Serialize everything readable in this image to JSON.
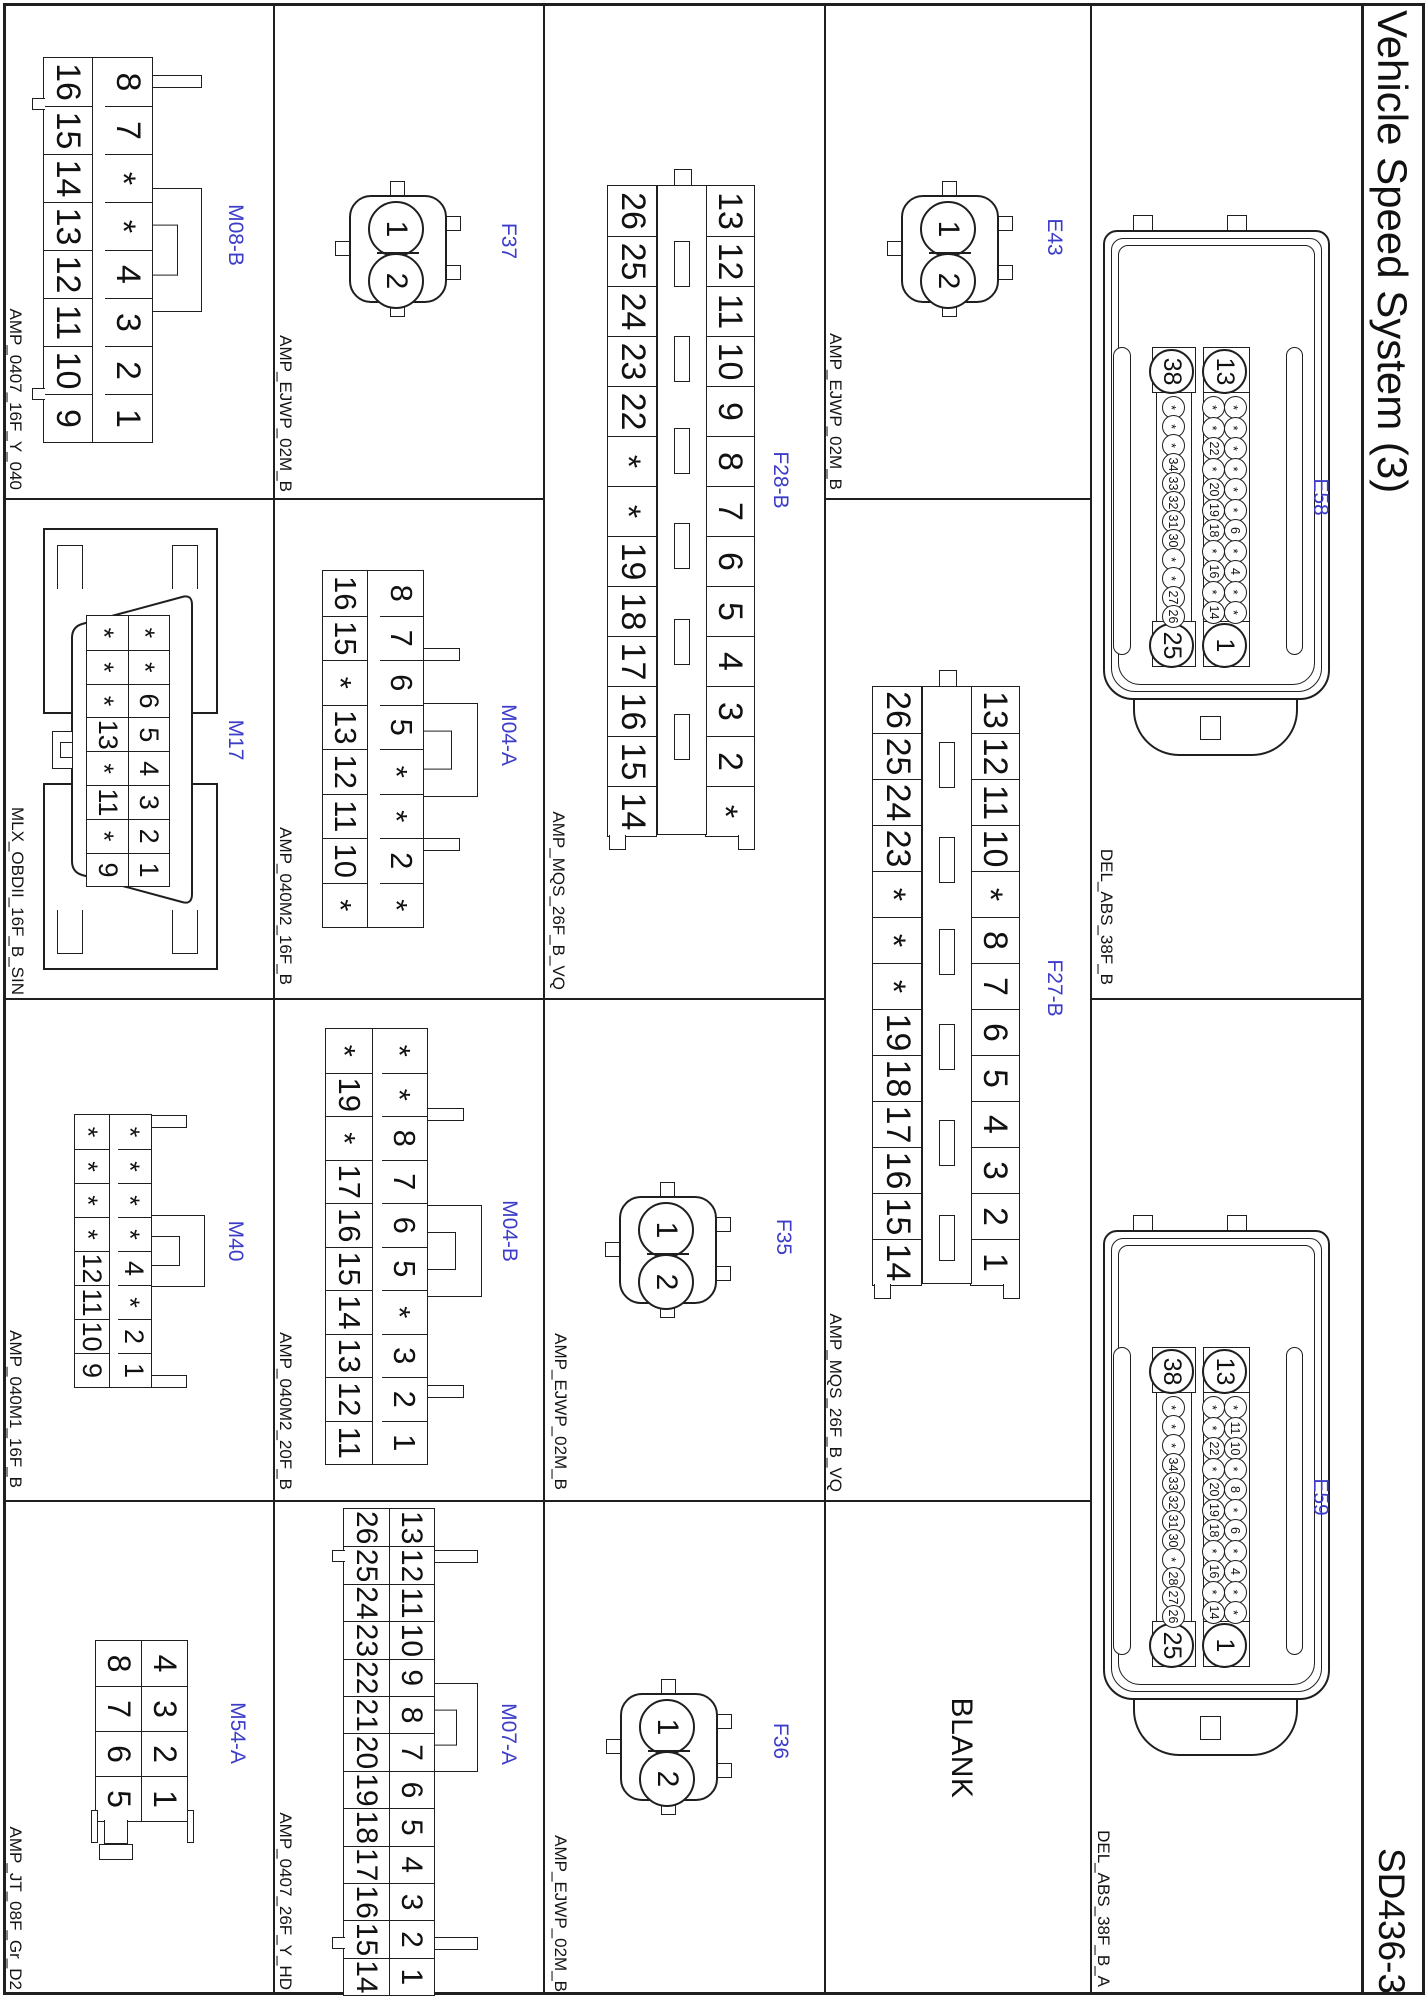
{
  "sheet": {
    "title": "Vehicle Speed System (3)",
    "doc_number": "SD436-3",
    "blank_cell_label": "BLANK",
    "accent_color": "#3c3cc8",
    "line_color": "#1f1f1f"
  },
  "connectors": [
    {
      "id": "E58",
      "part": "DEL_ABS_38F_B",
      "type": "del38",
      "corners": {
        "top_left": "13",
        "top_right": "1",
        "bottom_left": "38",
        "bottom_right": "25"
      },
      "upper_top": [
        "*",
        "*",
        "*",
        "*",
        "*",
        "*",
        "6",
        "*",
        "4",
        "*",
        "*"
      ],
      "upper_bottom": [
        "*",
        "*",
        "22",
        "*",
        "20",
        "19",
        "18",
        "*",
        "16",
        "*",
        "14"
      ],
      "lower": [
        "*",
        "*",
        "*",
        "34",
        "33",
        "32",
        "31",
        "30",
        "*",
        "*",
        "27",
        "26"
      ]
    },
    {
      "id": "E59",
      "part": "DEL_ABS_38F_B_A",
      "type": "del38",
      "corners": {
        "top_left": "13",
        "top_right": "1",
        "bottom_left": "38",
        "bottom_right": "25"
      },
      "upper_top": [
        "*",
        "11",
        "10",
        "*",
        "8",
        "*",
        "6",
        "*",
        "4",
        "*",
        "*"
      ],
      "upper_bottom": [
        "*",
        "*",
        "22",
        "*",
        "20",
        "19",
        "18",
        "*",
        "16",
        "*",
        "14"
      ],
      "lower": [
        "*",
        "*",
        "*",
        "34",
        "33",
        "32",
        "31",
        "30",
        "*",
        "28",
        "27",
        "26"
      ]
    },
    {
      "id": "E43",
      "part": "AMP_EJWP_02M_B",
      "type": "twopin",
      "pins": [
        "1",
        "2"
      ]
    },
    {
      "id": "F27-B",
      "part": "AMP_MQS_26F_B_VQ",
      "type": "mqs",
      "row_top": [
        "13",
        "12",
        "11",
        "10",
        "*",
        "8",
        "7",
        "6",
        "5",
        "4",
        "3",
        "2",
        "1"
      ],
      "row_bottom": [
        "26",
        "25",
        "24",
        "23",
        "*",
        "*",
        "*",
        "19",
        "18",
        "17",
        "16",
        "15",
        "14"
      ]
    },
    {
      "id": "F28-B",
      "part": "AMP_MQS_26F_B_VQ",
      "type": "mqs",
      "row_top": [
        "13",
        "12",
        "11",
        "10",
        "9",
        "8",
        "7",
        "6",
        "5",
        "4",
        "3",
        "2",
        "*"
      ],
      "row_bottom": [
        "26",
        "25",
        "24",
        "23",
        "22",
        "*",
        "*",
        "19",
        "18",
        "17",
        "16",
        "15",
        "14"
      ]
    },
    {
      "id": "F35",
      "part": "AMP_EJWP_02M_B",
      "type": "twopin",
      "pins": [
        "1",
        "2"
      ]
    },
    {
      "id": "F36",
      "part": "AMP_EJWP_02M_B",
      "type": "twopin",
      "pins": [
        "1",
        "2"
      ]
    },
    {
      "id": "F37",
      "part": "AMP_EJWP_02M_B",
      "type": "twopin",
      "pins": [
        "1",
        "2"
      ]
    },
    {
      "id": "M04-A",
      "part": "AMP_040M2_16F_B",
      "type": "grid",
      "row_top": [
        "8",
        "7",
        "6",
        "5",
        "*",
        "*",
        "2",
        "*"
      ],
      "row_bottom": [
        "16",
        "15",
        "*",
        "13",
        "12",
        "11",
        "10",
        "*"
      ]
    },
    {
      "id": "M04-B",
      "part": "AMP_040M2_20F_B",
      "type": "grid",
      "row_top": [
        "*",
        "*",
        "8",
        "7",
        "6",
        "5",
        "*",
        "3",
        "2",
        "1"
      ],
      "row_bottom": [
        "*",
        "19",
        "*",
        "17",
        "16",
        "15",
        "14",
        "13",
        "12",
        "11"
      ]
    },
    {
      "id": "M07-A",
      "part": "AMP_0407_26F_Y_HD",
      "type": "grid",
      "row_top": [
        "13",
        "12",
        "11",
        "10",
        "9",
        "8",
        "7",
        "6",
        "5",
        "4",
        "3",
        "2",
        "1"
      ],
      "row_bottom": [
        "26",
        "25",
        "24",
        "23",
        "22",
        "21",
        "20",
        "19",
        "18",
        "17",
        "16",
        "15",
        "14"
      ]
    },
    {
      "id": "M08-B",
      "part": "AMP_0407_16F_Y_040",
      "type": "grid",
      "row_top": [
        "8",
        "7",
        "*",
        "*",
        "4",
        "3",
        "2",
        "1"
      ],
      "row_bottom": [
        "16",
        "15",
        "14",
        "13",
        "12",
        "11",
        "10",
        "9"
      ]
    },
    {
      "id": "M17",
      "part": "MLX_OBDII_16F_B_SIN",
      "type": "obd",
      "row_top": [
        "*",
        "*",
        "6",
        "5",
        "4",
        "3",
        "2",
        "1"
      ],
      "row_bottom": [
        "*",
        "*",
        "*",
        "13",
        "*",
        "11",
        "*",
        "9"
      ]
    },
    {
      "id": "M40",
      "part": "AMP_040M1_16F_B",
      "type": "grid",
      "row_top": [
        "*",
        "*",
        "*",
        "*",
        "4",
        "*",
        "2",
        "1"
      ],
      "row_bottom": [
        "*",
        "*",
        "*",
        "*",
        "12",
        "11",
        "10",
        "9"
      ]
    },
    {
      "id": "M54-A",
      "part": "AMP_JT_08F_Gr_D2",
      "type": "grid",
      "row_top": [
        "4",
        "3",
        "2",
        "1"
      ],
      "row_bottom": [
        "8",
        "7",
        "6",
        "5"
      ]
    }
  ]
}
